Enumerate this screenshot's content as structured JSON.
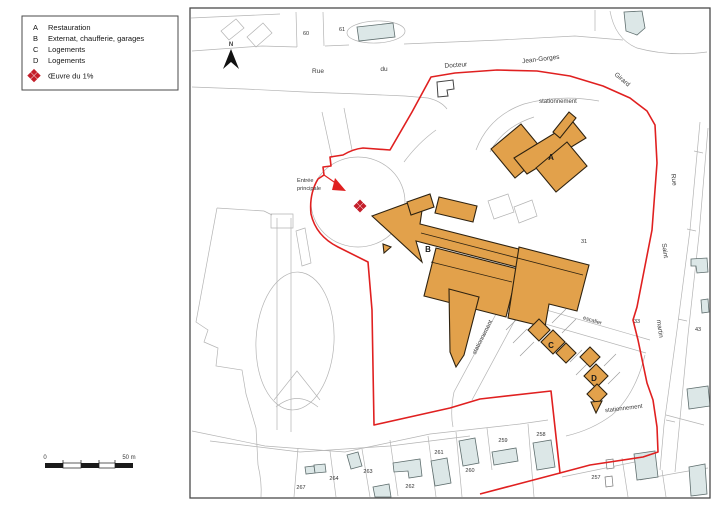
{
  "colors": {
    "boundary_red": "#e02020",
    "artwork_red": "#c41e2a",
    "building_tan": "#e2a14b",
    "house_gray": "#dce7e7"
  },
  "legend": {
    "items": [
      {
        "key": "A",
        "label": "Restauration"
      },
      {
        "key": "B",
        "label": "Externat, chaufferie, garages"
      },
      {
        "key": "C",
        "label": "Logements"
      },
      {
        "key": "D",
        "label": "Logements"
      }
    ],
    "artwork_label": "Œuvre du 1%"
  },
  "compass": {
    "north": "N"
  },
  "scale_bar": {
    "zero": "0",
    "max": "50 m"
  },
  "streets": {
    "rue": "Rue",
    "du": "du",
    "docteur": "Docteur",
    "jean_gorges": "Jean-Gorges",
    "girard": "Girard",
    "rue_right": "Rue",
    "saint": "Saint",
    "martin": "martin"
  },
  "site_labels": {
    "entrance_line1": "Entrée",
    "entrance_line2": "principale",
    "parking": "stationnement",
    "stairs": "escalier",
    "building_a": "A",
    "building_b": "B",
    "building_c": "C",
    "building_d": "D"
  },
  "parcel_numbers": {
    "n60": "60",
    "n61": "61",
    "n31": "31",
    "n33": "33",
    "n43": "43",
    "n257": "257",
    "n258": "258",
    "n259": "259",
    "n260": "260",
    "n261": "261",
    "n262": "262",
    "n263": "263",
    "n264": "264",
    "n267": "267"
  }
}
